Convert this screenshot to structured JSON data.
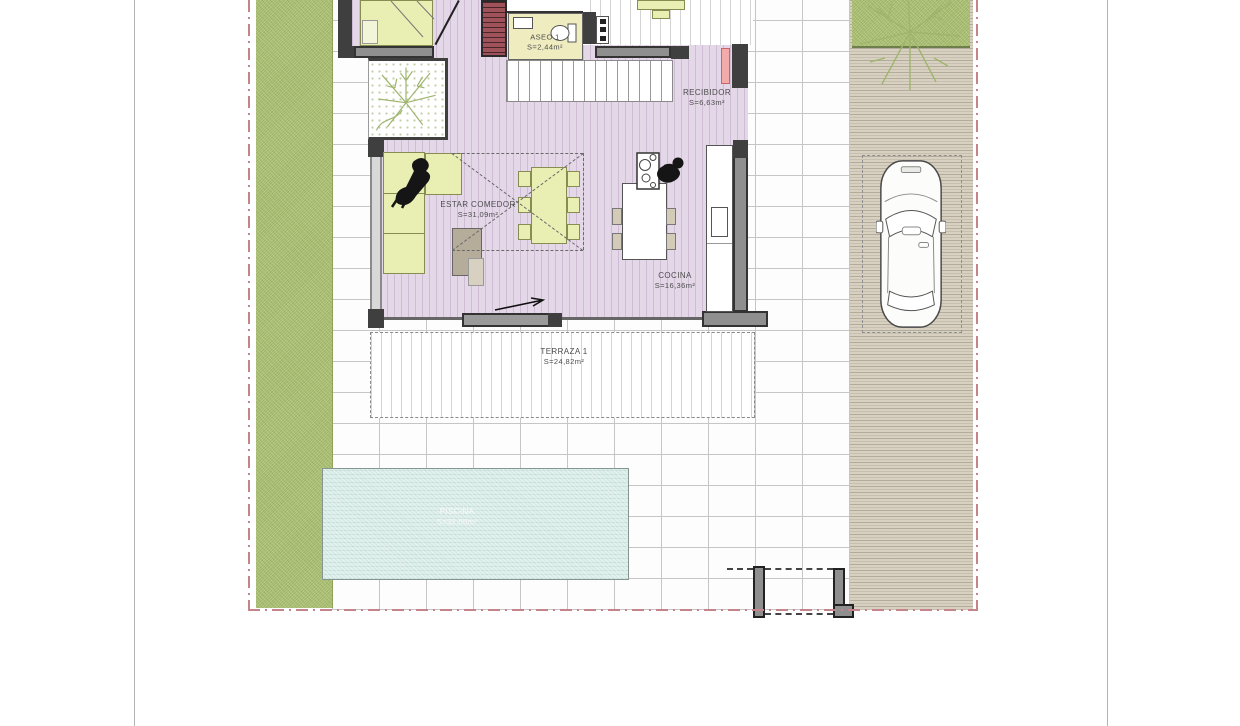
{
  "plan": {
    "rooms": [
      {
        "id": "aseo",
        "name": "ASEO 1",
        "area": "S=2,44m²"
      },
      {
        "id": "recibidor",
        "name": "RECIBIDOR",
        "area": "S=6,63m²"
      },
      {
        "id": "estar-comedor",
        "name": "ESTAR COMEDOR",
        "area": "S=31,09m²"
      },
      {
        "id": "cocina",
        "name": "COCINA",
        "area": "S=16,36m²"
      },
      {
        "id": "terraza",
        "name": "TERRAZA 1",
        "area": "S=24,82m²"
      },
      {
        "id": "piscina",
        "name": "PISCINA",
        "area": "S=32,00m²"
      }
    ],
    "objects": [
      "car-top-view",
      "parking-space",
      "tree-courtyard",
      "tree-garden",
      "person-on-sofa",
      "person-at-island",
      "sofa",
      "dining-table-with-chairs",
      "kitchen-island-with-stools",
      "bed",
      "red-staircase",
      "wide-staircase",
      "pool",
      "entry-door",
      "gate-walls"
    ],
    "colors": {
      "floor_lavender": "#e4d7e8",
      "furniture_green": "#e9efb2",
      "aseo_yellow": "#efedc0",
      "grass": "#afc478",
      "driveway_tan": "#d8d1c2",
      "pool_blue": "#d7ebe7",
      "wall_dark": "#3f3f3f",
      "boundary_dash_pink": "#c4848a",
      "stairs_red": "#a0525a",
      "door_pink": "#f2aaaa"
    }
  }
}
